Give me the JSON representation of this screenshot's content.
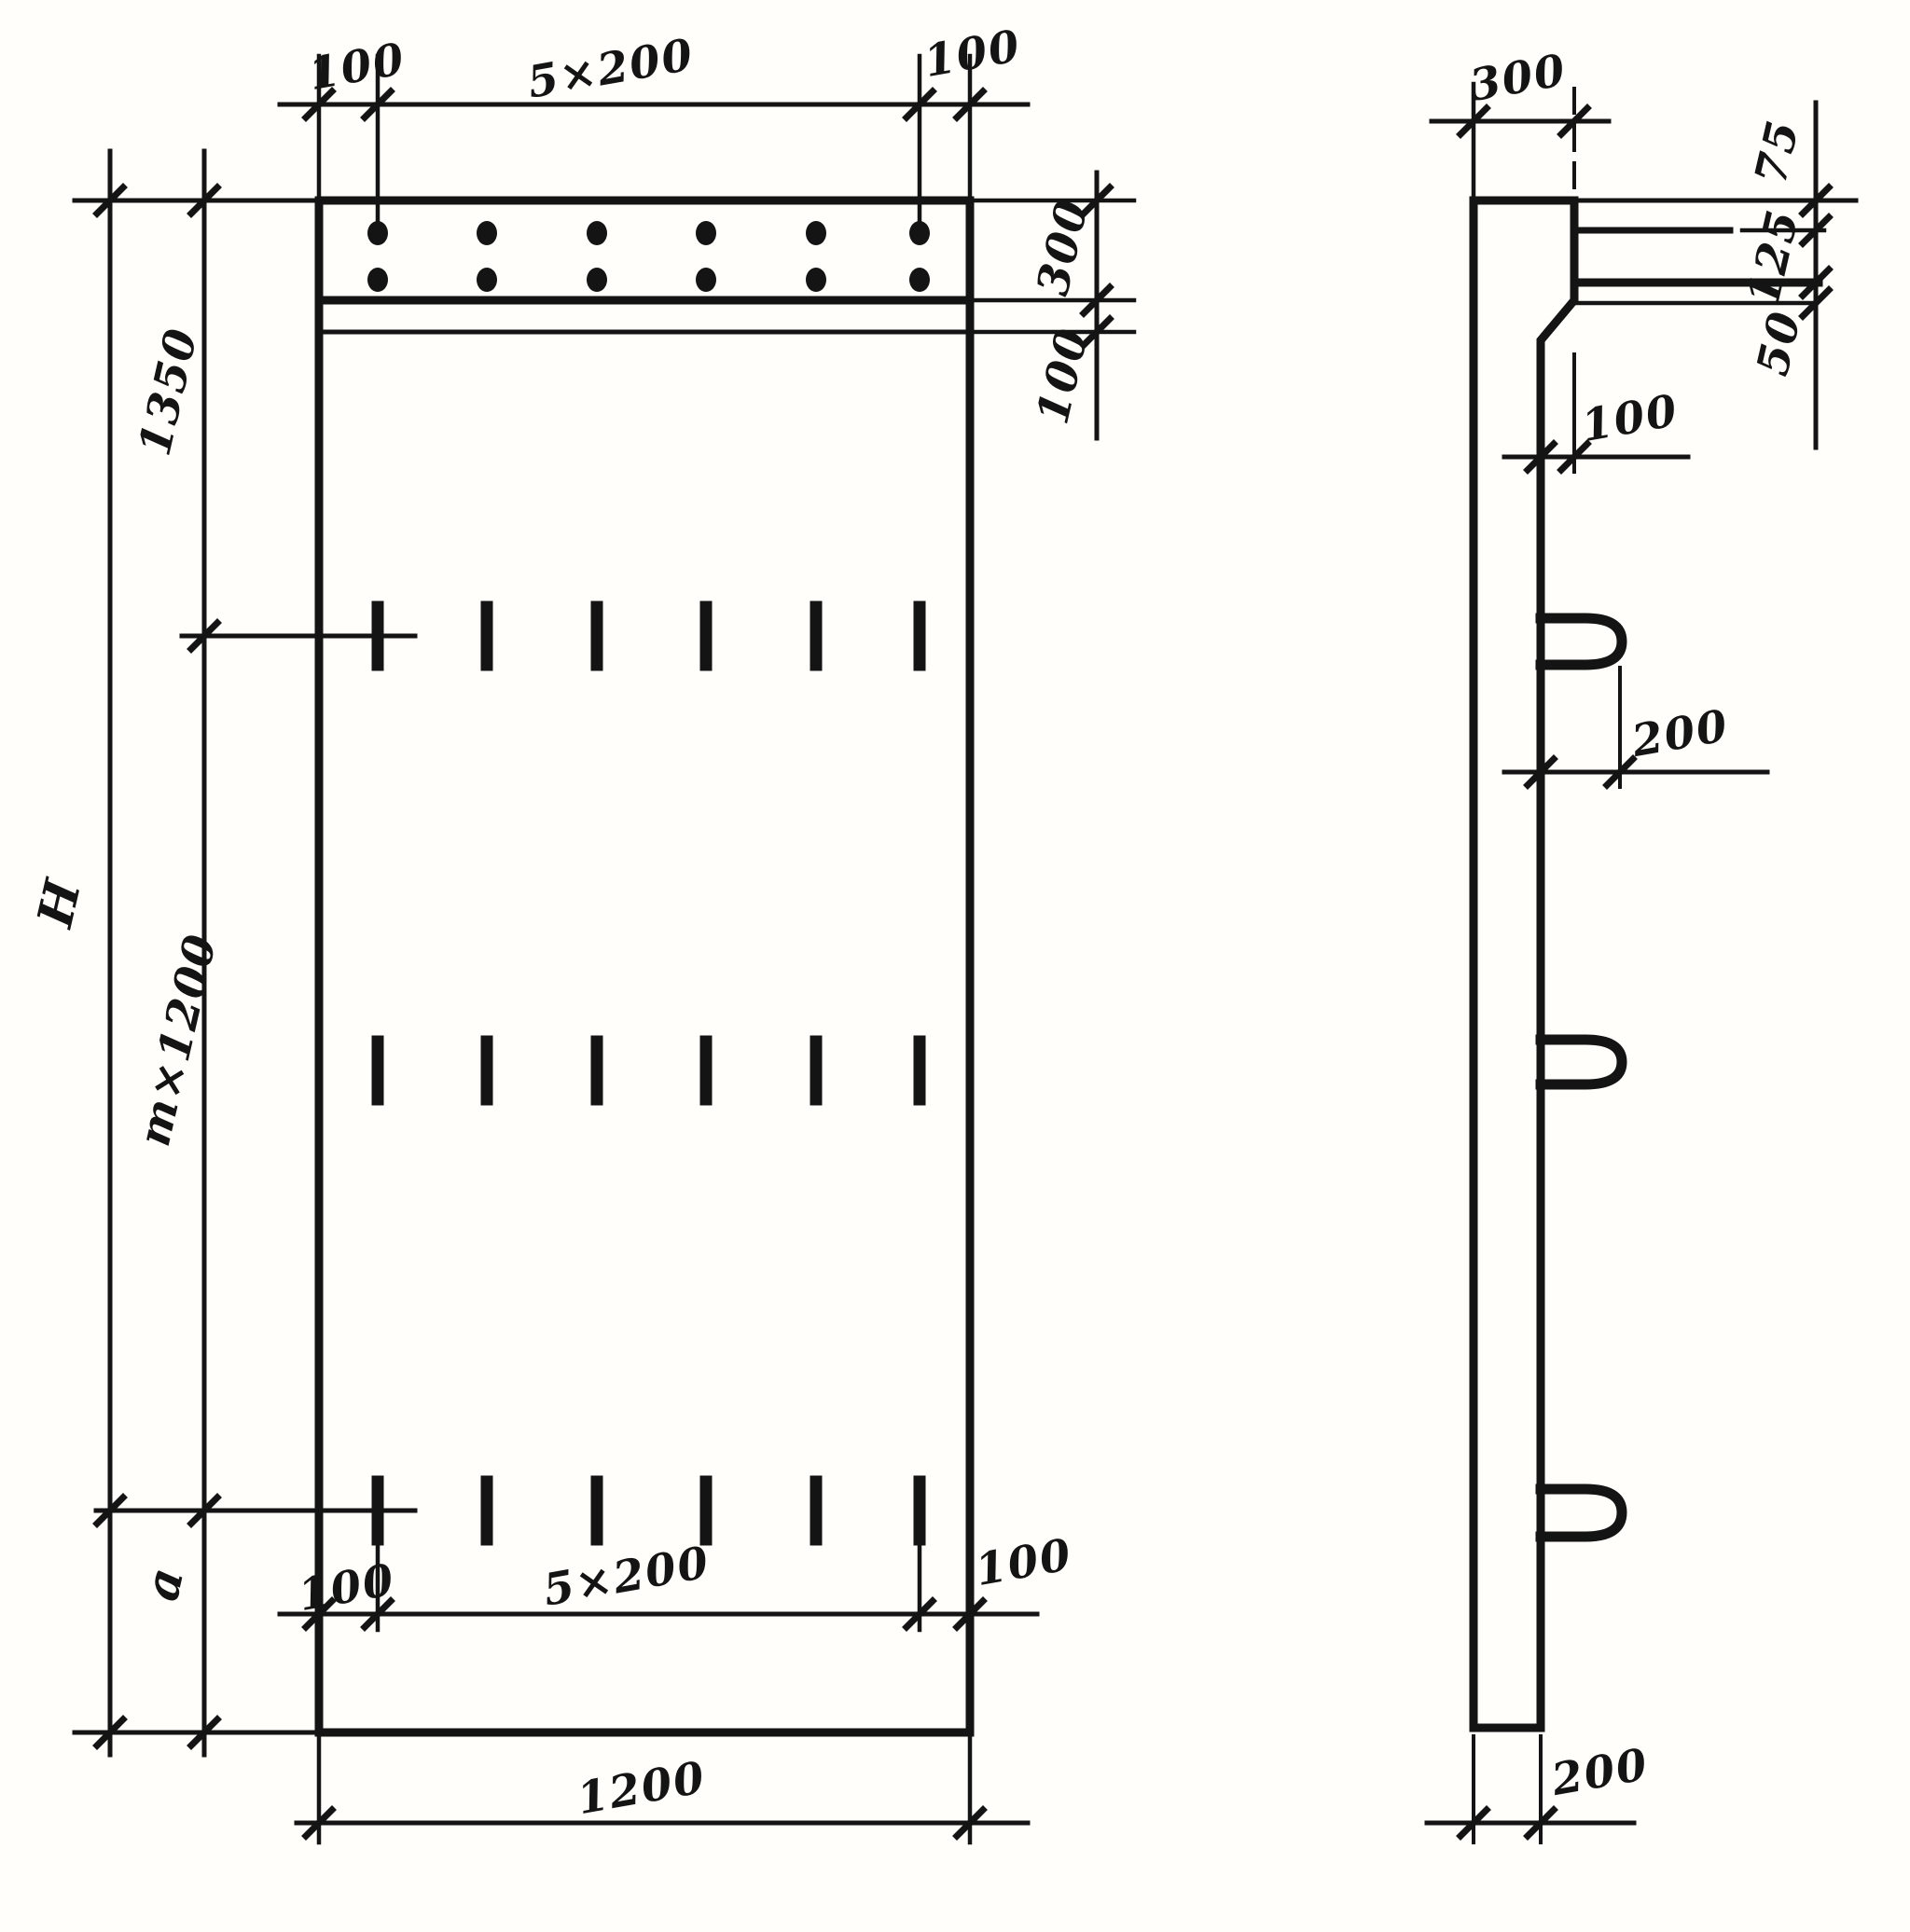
{
  "drawing": {
    "kind": "technical-drawing",
    "description": "Reinforced concrete panel: front elevation (left) and side section (right) with dimension annotations",
    "line_color": "#141414",
    "background_color": "#fffefb",
    "front_view": {
      "top_dim_left_margin": "100",
      "top_dim_spacing": "5×200",
      "top_dim_right_margin": "100",
      "right_dim_band_height": "300",
      "right_dim_step_height": "100",
      "left_dim_upper": "1350",
      "left_dim_total": "H",
      "left_dim_module": "m×1200",
      "left_dim_bottom": "a",
      "bottom_dim_left_margin": "100",
      "bottom_dim_spacing": "5×200",
      "bottom_dim_right_margin": "100",
      "bottom_dim_width": "1200"
    },
    "side_view": {
      "top_dim_width": "300",
      "right_dim_top": "75",
      "right_dim_mid": "125",
      "right_dim_bottom": "50",
      "step_dim": "100",
      "loop_dim": "200",
      "bottom_dim_thickness": "200"
    }
  }
}
